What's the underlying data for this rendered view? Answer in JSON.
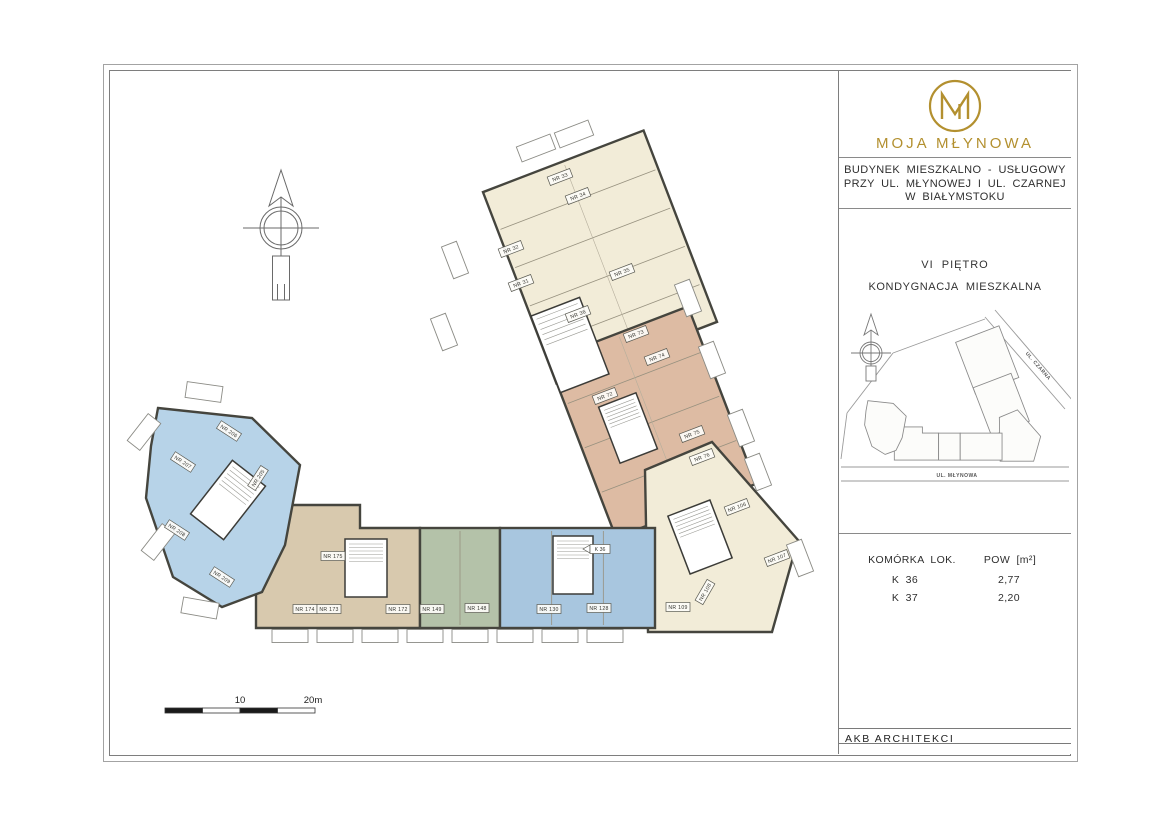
{
  "sheet": {
    "brand": {
      "name": "MOJA MŁYNOWA",
      "monogram_letter": "M",
      "gold": "#b3902f"
    },
    "title_lines": [
      "BUDYNEK  MIESZKALNO - USŁUGOWY",
      "PRZY  UL. MŁYNOWEJ  I  UL. CZARNEJ",
      "W  BIAŁYMSTOKU"
    ],
    "floor_title": "VI  PIĘTRO",
    "floor_subtitle": "KONDYGNACJA  MIESZKALNA",
    "architect": "AKB  ARCHITEKCI",
    "sitemap_streets": {
      "diagonal": "UL. CZARNA",
      "bottom": "UL. MŁYNOWA"
    },
    "storage_table": {
      "col1": "KOMÓRKA  LOK.",
      "col2": "POW  [m²]",
      "rows": [
        {
          "id": "K 36",
          "area": "2,77"
        },
        {
          "id": "K 37",
          "area": "2,20"
        }
      ]
    },
    "scale_bar": {
      "mid_label": "10",
      "end_label": "20m"
    }
  },
  "colors": {
    "cream": "#f2ecd8",
    "salmon": "#ddbba3",
    "tan": "#d8c9ae",
    "green": "#b4c2a9",
    "blue": "#a8c6df",
    "blueL": "#b7d3e8",
    "wall": "#45453e",
    "partition": "#97917f"
  },
  "floorplan": {
    "wings": [
      {
        "name": "wing-north",
        "shape": "rrect",
        "cx": 500,
        "cy": 197,
        "w": 172,
        "h": 205,
        "rot": -21,
        "color": "cream",
        "partitions": 5
      },
      {
        "name": "wing-mid",
        "shape": "rrect",
        "cx": 552,
        "cy": 362,
        "w": 150,
        "h": 190,
        "rot": -21,
        "color": "salmon",
        "partitions": 4
      },
      {
        "name": "wing-corner",
        "shape": "poly",
        "color": "cream",
        "points": [
          [
            545,
            410
          ],
          [
            612,
            382
          ],
          [
            698,
            480
          ],
          [
            672,
            572
          ],
          [
            548,
            572
          ]
        ]
      },
      {
        "name": "wing-south-tan",
        "shape": "poly",
        "color": "tan",
        "points": [
          [
            156,
            468
          ],
          [
            185,
            445
          ],
          [
            260,
            445
          ],
          [
            260,
            468
          ],
          [
            320,
            468
          ],
          [
            320,
            568
          ],
          [
            156,
            568
          ]
        ]
      },
      {
        "name": "wing-south-green",
        "shape": "rect",
        "x": 320,
        "y": 468,
        "w": 80,
        "h": 100,
        "color": "green",
        "partitions": 2
      },
      {
        "name": "wing-south-blue",
        "shape": "rect",
        "x": 400,
        "y": 468,
        "w": 155,
        "h": 100,
        "color": "blue",
        "partitions": 3
      },
      {
        "name": "wing-west",
        "shape": "poly",
        "color": "blueL",
        "points": [
          [
            58,
            348
          ],
          [
            152,
            358
          ],
          [
            200,
            405
          ],
          [
            185,
            485
          ],
          [
            162,
            532
          ],
          [
            122,
            547
          ],
          [
            73,
            517
          ],
          [
            46,
            438
          ],
          [
            51,
            386
          ]
        ]
      }
    ],
    "cores": [
      [
        470,
        285,
        52,
        82,
        -21
      ],
      [
        528,
        368,
        40,
        60,
        -21
      ],
      [
        600,
        477,
        45,
        62,
        -21
      ],
      [
        266,
        508,
        42,
        58,
        0
      ],
      [
        473,
        505,
        40,
        58,
        0
      ],
      [
        128,
        440,
        42,
        68,
        38
      ]
    ],
    "balconies": [
      [
        436,
        88,
        36,
        16,
        -21
      ],
      [
        474,
        74,
        36,
        16,
        -21
      ],
      [
        355,
        200,
        16,
        34,
        -21
      ],
      [
        344,
        272,
        16,
        34,
        -21
      ],
      [
        588,
        238,
        16,
        34,
        -21
      ],
      [
        612,
        300,
        16,
        34,
        -21
      ],
      [
        641,
        368,
        16,
        34,
        -21
      ],
      [
        658,
        412,
        16,
        34,
        -21
      ],
      [
        700,
        498,
        16,
        34,
        -21
      ],
      [
        190,
        576,
        36,
        13,
        0
      ],
      [
        235,
        576,
        36,
        13,
        0
      ],
      [
        280,
        576,
        36,
        13,
        0
      ],
      [
        325,
        576,
        36,
        13,
        0
      ],
      [
        370,
        576,
        36,
        13,
        0
      ],
      [
        415,
        576,
        36,
        13,
        0
      ],
      [
        460,
        576,
        36,
        13,
        0
      ],
      [
        505,
        576,
        36,
        13,
        0
      ],
      [
        44,
        372,
        16,
        34,
        38
      ],
      [
        58,
        482,
        16,
        34,
        38
      ],
      [
        100,
        548,
        36,
        16,
        10
      ],
      [
        104,
        332,
        36,
        16,
        8
      ]
    ],
    "units": [
      {
        "label": "NR 33",
        "x": 460,
        "y": 117,
        "rot": -21
      },
      {
        "label": "NR 34",
        "x": 478,
        "y": 136,
        "rot": -21
      },
      {
        "label": "NR 32",
        "x": 411,
        "y": 189,
        "rot": -21
      },
      {
        "label": "NR 31",
        "x": 421,
        "y": 223,
        "rot": -21
      },
      {
        "label": "NR 35",
        "x": 522,
        "y": 212,
        "rot": -21
      },
      {
        "label": "NR 36",
        "x": 478,
        "y": 254,
        "rot": -21
      },
      {
        "label": "NR 73",
        "x": 536,
        "y": 274,
        "rot": -21
      },
      {
        "label": "NR 74",
        "x": 557,
        "y": 297,
        "rot": -21
      },
      {
        "label": "NR 72",
        "x": 505,
        "y": 336,
        "rot": -21
      },
      {
        "label": "NR 75",
        "x": 592,
        "y": 374,
        "rot": -21
      },
      {
        "label": "NR 76",
        "x": 602,
        "y": 397,
        "rot": -21
      },
      {
        "label": "NR 106",
        "x": 637,
        "y": 447,
        "rot": -21
      },
      {
        "label": "NR 107",
        "x": 677,
        "y": 498,
        "rot": -21
      },
      {
        "label": "NR 108",
        "x": 605,
        "y": 532,
        "rot": -60
      },
      {
        "label": "NR 109",
        "x": 578,
        "y": 547,
        "rot": 0
      },
      {
        "label": "NR 175",
        "x": 233,
        "y": 496,
        "rot": 0
      },
      {
        "label": "NR 174",
        "x": 205,
        "y": 549,
        "rot": 0
      },
      {
        "label": "NR 173",
        "x": 229,
        "y": 549,
        "rot": 0
      },
      {
        "label": "NR 172",
        "x": 298,
        "y": 549,
        "rot": 0
      },
      {
        "label": "NR 149",
        "x": 332,
        "y": 549,
        "rot": 0
      },
      {
        "label": "NR 148",
        "x": 377,
        "y": 548,
        "rot": 0
      },
      {
        "label": "NR 130",
        "x": 449,
        "y": 549,
        "rot": 0
      },
      {
        "label": "NR 128",
        "x": 499,
        "y": 548,
        "rot": 0
      },
      {
        "label": "NR 205",
        "x": 158,
        "y": 418,
        "rot": -57
      },
      {
        "label": "NR 206",
        "x": 129,
        "y": 371,
        "rot": 33
      },
      {
        "label": "NR 207",
        "x": 83,
        "y": 402,
        "rot": 33
      },
      {
        "label": "NR 208",
        "x": 77,
        "y": 470,
        "rot": 33
      },
      {
        "label": "NR 209",
        "x": 122,
        "y": 517,
        "rot": 33
      }
    ],
    "annotations": [
      {
        "label": "K 36",
        "x": 498,
        "y": 489
      }
    ]
  }
}
